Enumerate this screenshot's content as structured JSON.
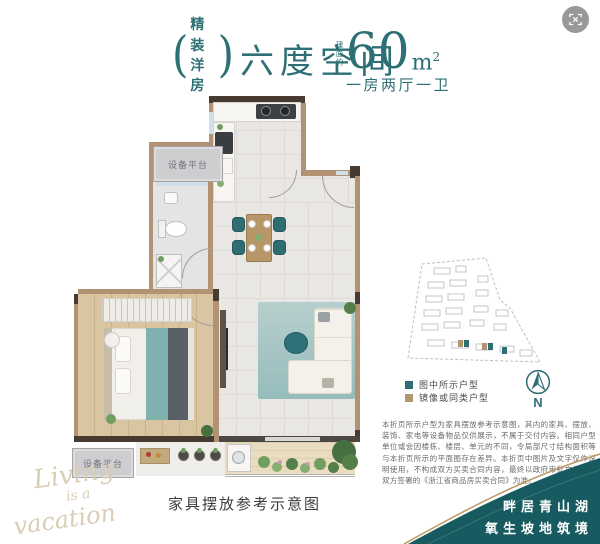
{
  "header": {
    "badge": {
      "bracket_left": "(",
      "line1": "精装",
      "line2": "洋房",
      "bracket_right": ")"
    },
    "title": "六度空间",
    "area": {
      "prefix": "建面约",
      "value": "60",
      "unit": "m",
      "sup": "2"
    },
    "subtitle": "一房两厅一卫"
  },
  "plan": {
    "labels": {
      "equipment_platform_top": "设备平台",
      "equipment_platform_bottom": "设备平台"
    },
    "caption": "家具摆放参考示意图"
  },
  "watermark": {
    "line1": "Living",
    "line2": "is a",
    "line3": "vacation"
  },
  "sitemap": {
    "legend": [
      {
        "label": "图中所示户型",
        "color": "#2D6F74"
      },
      {
        "label": "镜像或同类户型",
        "color": "#B39470"
      }
    ],
    "compass_label": "N"
  },
  "disclaimer": "本折页所示户型为家具摆放参考示意图，其内的家具、摆放、装饰、家电等设备物品仅供展示，不属于交付内容。相同户型单位或会因楼栋、楼层、单元的不同，令局部尺寸结构面积等与本折页所示的平面图存在差异。本折页中图片及文字仅作说明使用，不构成双方买卖合同内容，最终以政府审批文件以及双方签署的《浙江省商品房买卖合同》为准。",
  "wave": {
    "slogan_line1": "畔居青山湖",
    "slogan_line2": "氧生坡地筑境",
    "teal": "#175A60",
    "gold": "#BC9E6C"
  },
  "colors": {
    "accent_teal": "#2D6F74",
    "wall_tan": "#B29273",
    "wall_dark": "#473B31"
  }
}
